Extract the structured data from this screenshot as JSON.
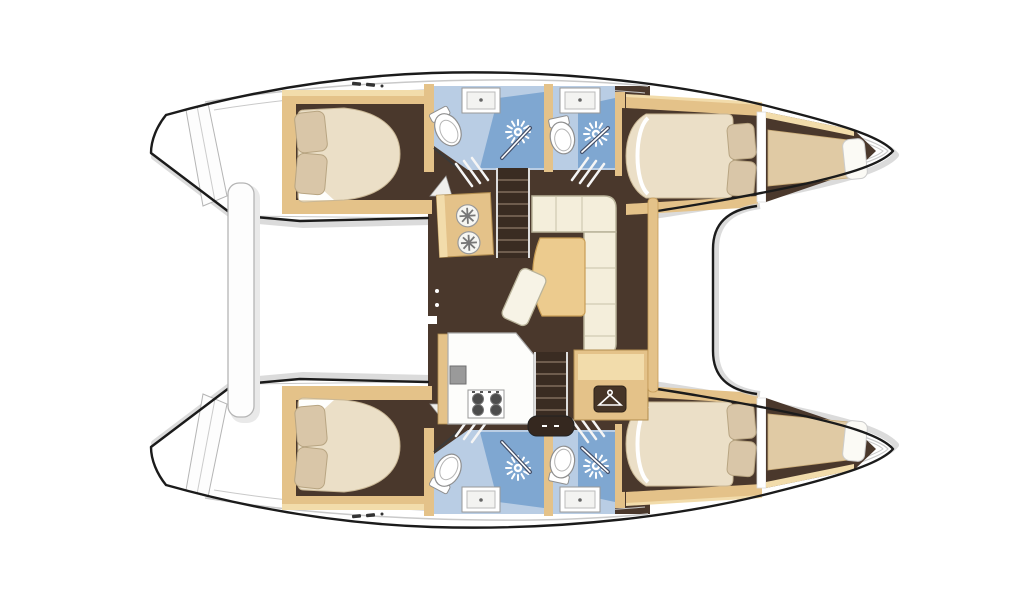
{
  "diagram": {
    "kind": "boat-floor-plan",
    "subject": "catamaran-interior-layout",
    "orientation": {
      "bow_side": "right",
      "stern_side": "left"
    },
    "rooms": {
      "hulls": 2,
      "double_cabins": 4,
      "bathrooms": 4,
      "showers": 4,
      "bow_berths": 2
    },
    "saloon_features": {
      "sofa": "L-shaped sofa",
      "table": "saloon table",
      "stool": "bench stool",
      "galley": "galley counter with 4-burner stove and sink",
      "basin_unit": "twin round basin unit",
      "wardrobe": "wardrobe cabinet",
      "stairs": "companionway steps to each hull"
    },
    "icons": {
      "shower_drain": "sunburst-drain",
      "wardrobe_badge": "clothes-hanger",
      "stove": "four-burner-hob",
      "basins": "two-round-basins",
      "deck_fittings": "cleat-marks"
    }
  },
  "colors": {
    "outline": "#1b1b1b",
    "shadow": "#d2d2d2",
    "hull_white": "#ffffff",
    "deck_line": "#c9c9c9",
    "floor_dark": "#4a382c",
    "wood": "#e4c289",
    "wood_light": "#f2dcab",
    "wood_dark": "#c49a58",
    "mattress": "#ebdfc7",
    "mattress_edge": "#c9b795",
    "pillow": "#d9c6a8",
    "pillow_edge": "#b8a582",
    "bath_floor": "#b9cde4",
    "shower_blue": "#7fa7d1",
    "fixture": "#ffffff",
    "fixture_edge": "#8f8f8f",
    "stair_dark": "#3a2c22",
    "step_line": "#6f5d4e",
    "badge": "#463527",
    "cream": "#f4eedb",
    "cream_edge": "#b9b39a",
    "table": "#eccb8e",
    "burner": "#4c4c4c"
  }
}
